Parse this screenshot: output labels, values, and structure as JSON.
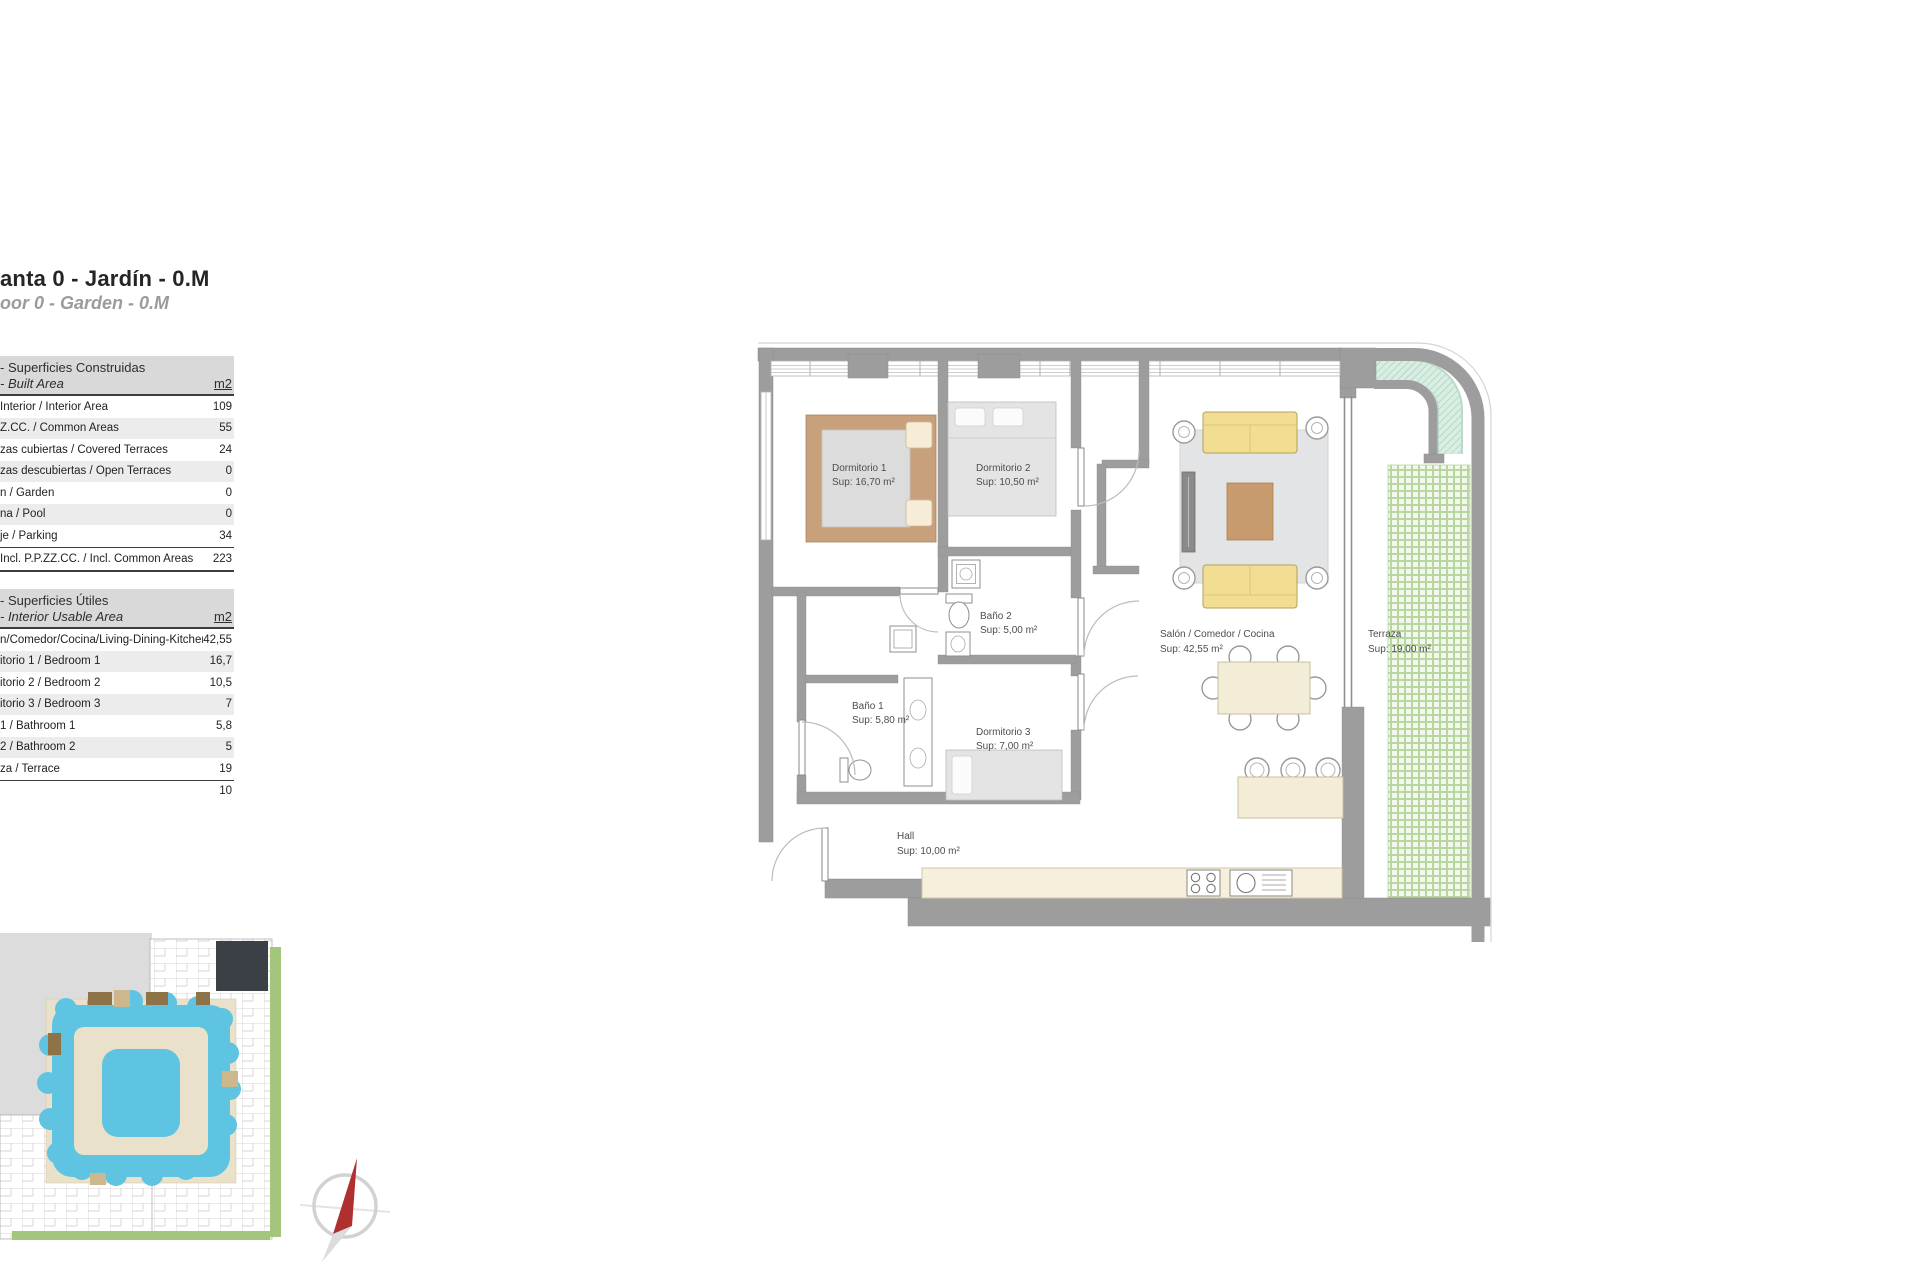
{
  "page": {
    "title": "anta 0 - Jardín - 0.M",
    "subtitle": "oor 0 - Garden - 0.M"
  },
  "built_area_table": {
    "title_es": "- Superficies Construidas",
    "title_en": "- Built Area",
    "unit": "m2",
    "rows": [
      {
        "label": "Interior / Interior Area",
        "value": "109"
      },
      {
        "label": "Z.CC. / Common Areas",
        "value": "55"
      },
      {
        "label": "zas cubiertas / Covered Terraces",
        "value": "24"
      },
      {
        "label": "zas descubiertas / Open Terraces",
        "value": "0"
      },
      {
        "label": "n / Garden",
        "value": "0"
      },
      {
        "label": "na / Pool",
        "value": "0"
      },
      {
        "label": "je / Parking",
        "value": "34"
      }
    ],
    "total": {
      "label": "Incl. P.P.ZZ.CC. / Incl. Common Areas",
      "value": "223"
    }
  },
  "usable_area_table": {
    "title_es": "- Superficies Útiles",
    "title_en": "- Interior Usable Area",
    "unit": "m2",
    "rows": [
      {
        "label": "n/Comedor/Cocina/Living-Dining-Kitchen",
        "value": "42,55"
      },
      {
        "label": "itorio 1 / Bedroom 1",
        "value": "16,7"
      },
      {
        "label": "itorio 2 / Bedroom 2",
        "value": "10,5"
      },
      {
        "label": "itorio 3 / Bedroom 3",
        "value": "7"
      },
      {
        "label": "1 / Bathroom 1",
        "value": "5,8"
      },
      {
        "label": "2 / Bathroom 2",
        "value": "5"
      },
      {
        "label": "za / Terrace",
        "value": "19"
      },
      {
        "label": "",
        "value": "10"
      }
    ]
  },
  "floorplan": {
    "rooms": [
      {
        "name": "Dormitorio 1",
        "sup": "Sup: 16,70 m²"
      },
      {
        "name": "Dormitorio 2",
        "sup": "Sup: 10,50 m²"
      },
      {
        "name": "Baño 2",
        "sup": "Sup: 5,00 m²"
      },
      {
        "name": "Baño 1",
        "sup": "Sup: 5,80 m²"
      },
      {
        "name": "Dormitorio 3",
        "sup": "Sup: 7,00 m²"
      },
      {
        "name": "Salón / Comedor / Cocina",
        "sup": "Sup: 42,55 m²"
      },
      {
        "name": "Terraza",
        "sup": "Sup: 19,00 m²"
      },
      {
        "name": "Hall",
        "sup": "Sup: 10,00 m²"
      }
    ]
  },
  "palette": {
    "wall_gray": "#9d9d9d",
    "sofa_yellow": "#f2de92",
    "wood_brown": "#c79b6d",
    "bed_frame_tan": "#c8a07b",
    "counter_cream": "#f6efdb",
    "terrace_grid_green": "#a8cf8c",
    "mint_band": "#d9eee3",
    "pool_blue": "#5fc4e2",
    "site_dark_unit": "#3b4046",
    "site_green": "#a4c57c",
    "compass_red": "#b03030"
  }
}
